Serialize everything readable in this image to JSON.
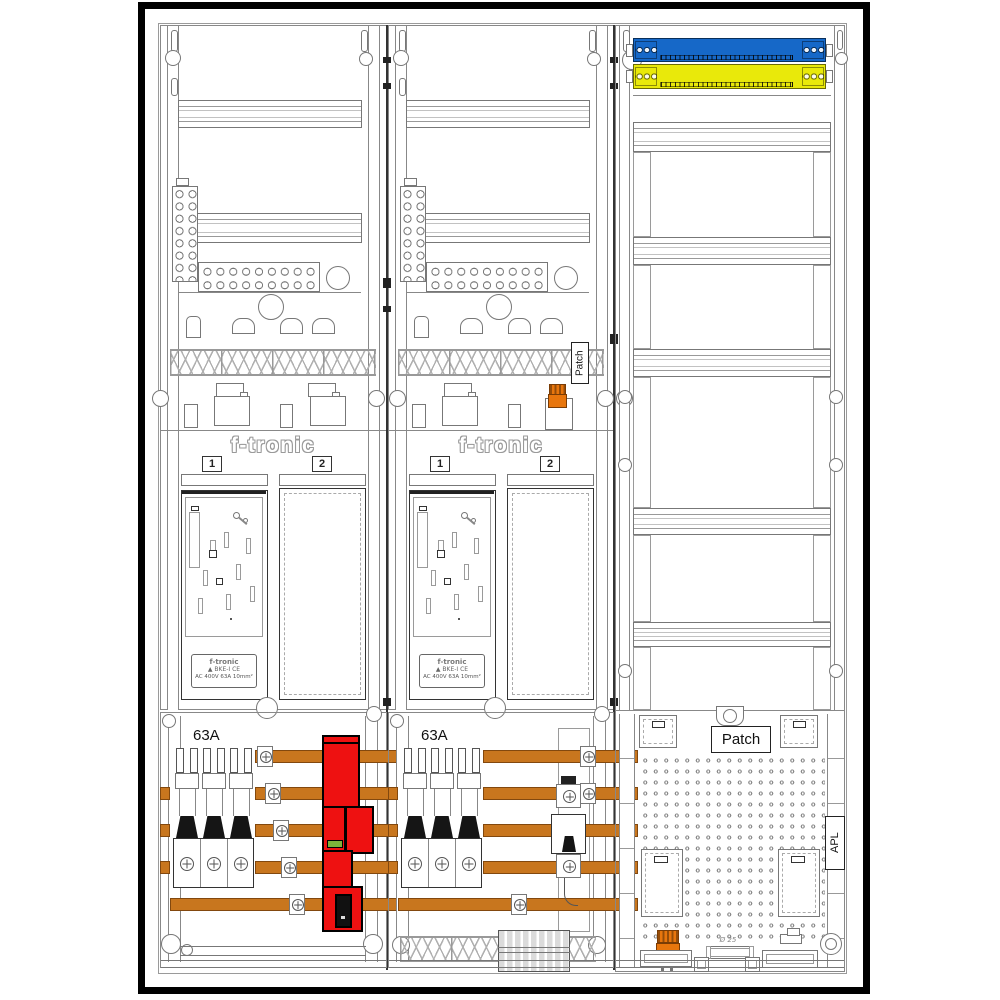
{
  "drawing": {
    "title_hint": "meter cabinet layout drawing",
    "patch_label_top": "Patch",
    "meter_fields": [
      {
        "header": "f-tronic",
        "bay1_tag": "1",
        "bay2_tag": "2",
        "switch_rating": "63A",
        "sticker_line1": "f-tronic",
        "sticker_line2": "▲ BKE-I  CE",
        "sticker_line3": "AC 400V   63A   10mm²"
      },
      {
        "header": "f-tronic",
        "bay1_tag": "1",
        "bay2_tag": "2",
        "switch_rating": "63A",
        "sticker_line1": "f-tronic",
        "sticker_line2": "▲ BKE-I  CE",
        "sticker_line3": "AC 400V   63A   10mm²"
      }
    ],
    "distribution_field": {
      "patch_label": "Patch",
      "apl_label": "APL",
      "grommet_label": "Ø 25"
    },
    "colors": {
      "busbar_copper": "#C8761E",
      "sls_red": "#EE1111",
      "neutral_blue": "#1668C8",
      "pe_yellow": "#E9E90A",
      "connector_orange": "#E8760D",
      "indicator_green": "#7CB33A"
    }
  }
}
